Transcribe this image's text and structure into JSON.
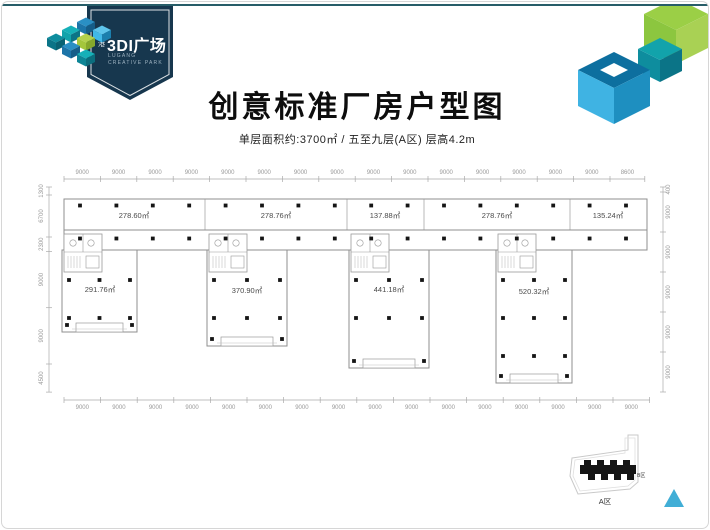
{
  "header": {
    "title": "创意标准厂房户型图",
    "subtitle": "单层面积约:3700㎡ / 五至九层(A区) 层高4.2m"
  },
  "logo": {
    "brand_cn_prefix": "绿港",
    "brand_cn_main": "3DI广场",
    "brand_en_line1": "LUGANG",
    "brand_en_line2": "CREATIVE PARK",
    "badge_color": "#17374e"
  },
  "floor_plan": {
    "top_dims": [
      "9000",
      "9000",
      "9000",
      "9000",
      "9000",
      "9000",
      "9000",
      "9000",
      "9000",
      "9000",
      "9000",
      "9000",
      "9000",
      "9000",
      "9000",
      "8600"
    ],
    "bottom_dims": [
      "9000",
      "9000",
      "9000",
      "9000",
      "9000",
      "9000",
      "9000",
      "9000",
      "9000",
      "9000",
      "9000",
      "9000",
      "9000",
      "9000",
      "9000",
      "9000"
    ],
    "left_dims": [
      "1300",
      "6700",
      "2300",
      "9000",
      "9000",
      "4500"
    ],
    "right_dims": [
      "400",
      "9000",
      "9000",
      "9000",
      "9000",
      "9000"
    ],
    "top_rooms": [
      {
        "area": "278.60㎡"
      },
      {
        "area": "278.76㎡"
      },
      {
        "area": "137.88㎡"
      },
      {
        "area": "278.76㎡"
      },
      {
        "area": "135.24㎡"
      }
    ],
    "wings": [
      {
        "area": "291.76㎡"
      },
      {
        "area": "370.90㎡"
      },
      {
        "area": "441.18㎡"
      },
      {
        "area": "520.32㎡"
      }
    ]
  },
  "site_map": {
    "zone_a_label": "A区",
    "zone_b_label": "B区"
  },
  "colors": {
    "accent_teal": "#12a3ab",
    "accent_blue": "#1c74a8",
    "accent_lightblue": "#41b9e8",
    "accent_green": "#8cc63f",
    "wall_gray": "#8f8f8f",
    "column_black": "#151515",
    "dim_gray": "#999999",
    "triangle_cyan": "#41aed6"
  }
}
